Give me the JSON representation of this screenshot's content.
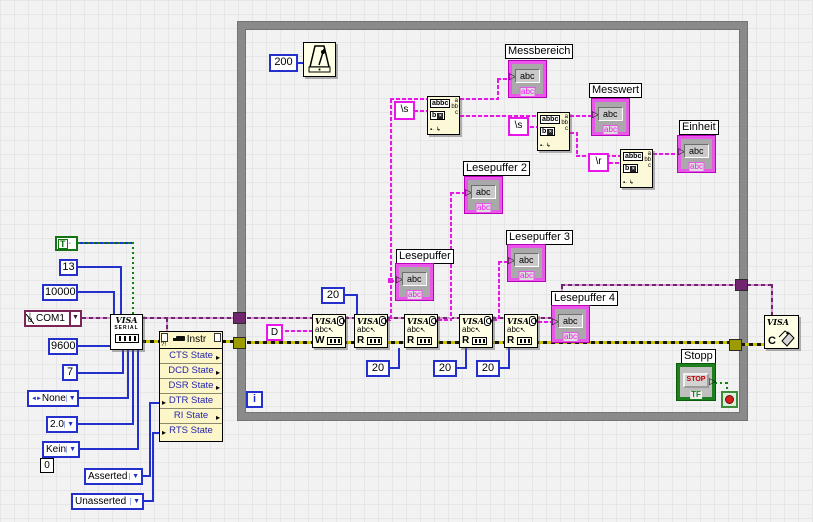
{
  "left_panel": {
    "true_const": "T",
    "termchar": "13",
    "timeout": "10000",
    "resource": "COM1",
    "baud": "9600",
    "databits": "7",
    "parity": "None",
    "stopbits": "2.0",
    "flow": "Kein",
    "zero": "0",
    "dtr_value": "Asserted",
    "rts_value": "Unasserted",
    "io_glyph": "I/O",
    "enum_glyph": "◄►",
    "dropdown_arrow": "▼"
  },
  "visa_serial": {
    "title": "VISA",
    "subtitle": "SERIAL"
  },
  "property_node": {
    "title": "Instr",
    "help_glyph": "?!",
    "rows": [
      {
        "label": "CTS State"
      },
      {
        "label": "DCD State"
      },
      {
        "label": "DSR State"
      },
      {
        "label": "DTR State"
      },
      {
        "label": "RI State"
      },
      {
        "label": "RTS State"
      }
    ]
  },
  "loop": {
    "wait_const": "200",
    "write_cmd": "D",
    "visa_label": "VISA",
    "abc": "abc",
    "blocks": [
      {
        "letter": "W"
      },
      {
        "letter": "R"
      },
      {
        "letter": "R"
      },
      {
        "letter": "R"
      },
      {
        "letter": "R"
      }
    ],
    "byte_counts": [
      "20",
      "20",
      "20",
      "20"
    ],
    "match_consts": [
      "\\s",
      "\\s",
      "\\r"
    ],
    "match_icon": {
      "row1": "abbc",
      "row2": "b",
      "out_a": "a",
      "out_b": "bb",
      "out_c": "c",
      "glyphs": "▪· ↳"
    },
    "indicators": [
      {
        "label": "Messbereich"
      },
      {
        "label": "Messwert"
      },
      {
        "label": "Einheit"
      },
      {
        "label": "Lesepuffer"
      },
      {
        "label": "Lesepuffer 2"
      },
      {
        "label": "Lesepuffer 3"
      },
      {
        "label": "Lesepuffer 4"
      }
    ],
    "indicator_field": "abc",
    "indicator_type": "abc",
    "input_arrow": "▷",
    "stop": {
      "label": "Stopp",
      "button": "STOP",
      "type": "TF"
    },
    "iteration": "i"
  },
  "visa_close": {
    "title": "VISA",
    "letter": "C"
  }
}
